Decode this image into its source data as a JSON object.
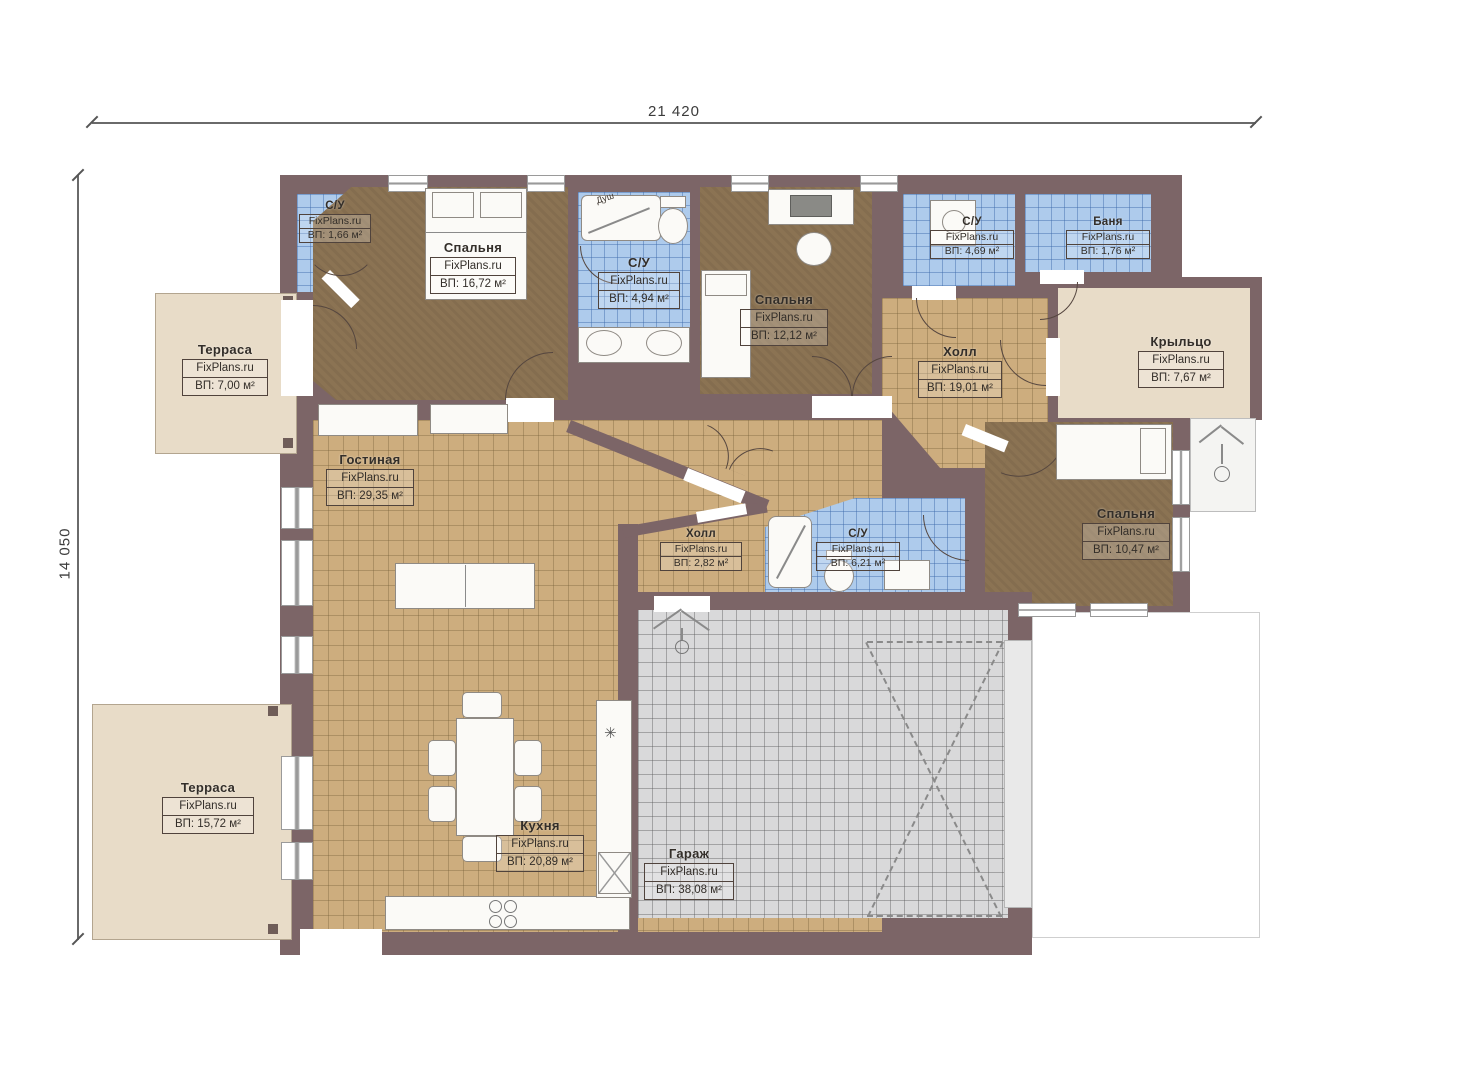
{
  "brand": "FixPlans.ru",
  "dimensions": {
    "width_label": "21 420",
    "height_label": "14 050"
  },
  "annotations": {
    "shower": "Душ"
  },
  "colors": {
    "wall": "#7c6567",
    "tile_tan": "#cdad7e",
    "tile_blue": "#aecbec",
    "carpet_brown": "#8b7353",
    "garage_gray": "#d9d9da",
    "terrace_beige": "#e8dcc8"
  },
  "rooms": [
    {
      "id": "wc1",
      "name": "С/У",
      "brand": "FixPlans.ru",
      "area": "ВП: 1,66 м²"
    },
    {
      "id": "bedroom1",
      "name": "Спальня",
      "brand": "FixPlans.ru",
      "area": "ВП: 16,72 м²"
    },
    {
      "id": "wc2",
      "name": "С/У",
      "brand": "FixPlans.ru",
      "area": "ВП: 4,94 м²"
    },
    {
      "id": "bedroom2",
      "name": "Спальня",
      "brand": "FixPlans.ru",
      "area": "ВП: 12,12 м²"
    },
    {
      "id": "wc3",
      "name": "С/У",
      "brand": "FixPlans.ru",
      "area": "ВП: 4,69 м²"
    },
    {
      "id": "banya",
      "name": "Баня",
      "brand": "FixPlans.ru",
      "area": "ВП: 1,76 м²"
    },
    {
      "id": "terrace1",
      "name": "Терраса",
      "brand": "FixPlans.ru",
      "area": "ВП: 7,00 м²"
    },
    {
      "id": "porch",
      "name": "Крыльцо",
      "brand": "FixPlans.ru",
      "area": "ВП: 7,67 м²"
    },
    {
      "id": "hall1",
      "name": "Холл",
      "brand": "FixPlans.ru",
      "area": "ВП: 19,01 м²"
    },
    {
      "id": "living",
      "name": "Гостиная",
      "brand": "FixPlans.ru",
      "area": "ВП: 29,35 м²"
    },
    {
      "id": "bedroom3",
      "name": "Спальня",
      "brand": "FixPlans.ru",
      "area": "ВП: 10,47 м²"
    },
    {
      "id": "hall2",
      "name": "Холл",
      "brand": "FixPlans.ru",
      "area": "ВП: 2,82 м²"
    },
    {
      "id": "wc4",
      "name": "С/У",
      "brand": "FixPlans.ru",
      "area": "ВП: 6,21 м²"
    },
    {
      "id": "kitchen",
      "name": "Кухня",
      "brand": "FixPlans.ru",
      "area": "ВП: 20,89 м²"
    },
    {
      "id": "garage",
      "name": "Гараж",
      "brand": "FixPlans.ru",
      "area": "ВП: 38,08 м²"
    },
    {
      "id": "terrace2",
      "name": "Терраса",
      "brand": "FixPlans.ru",
      "area": "ВП: 15,72 м²"
    }
  ]
}
